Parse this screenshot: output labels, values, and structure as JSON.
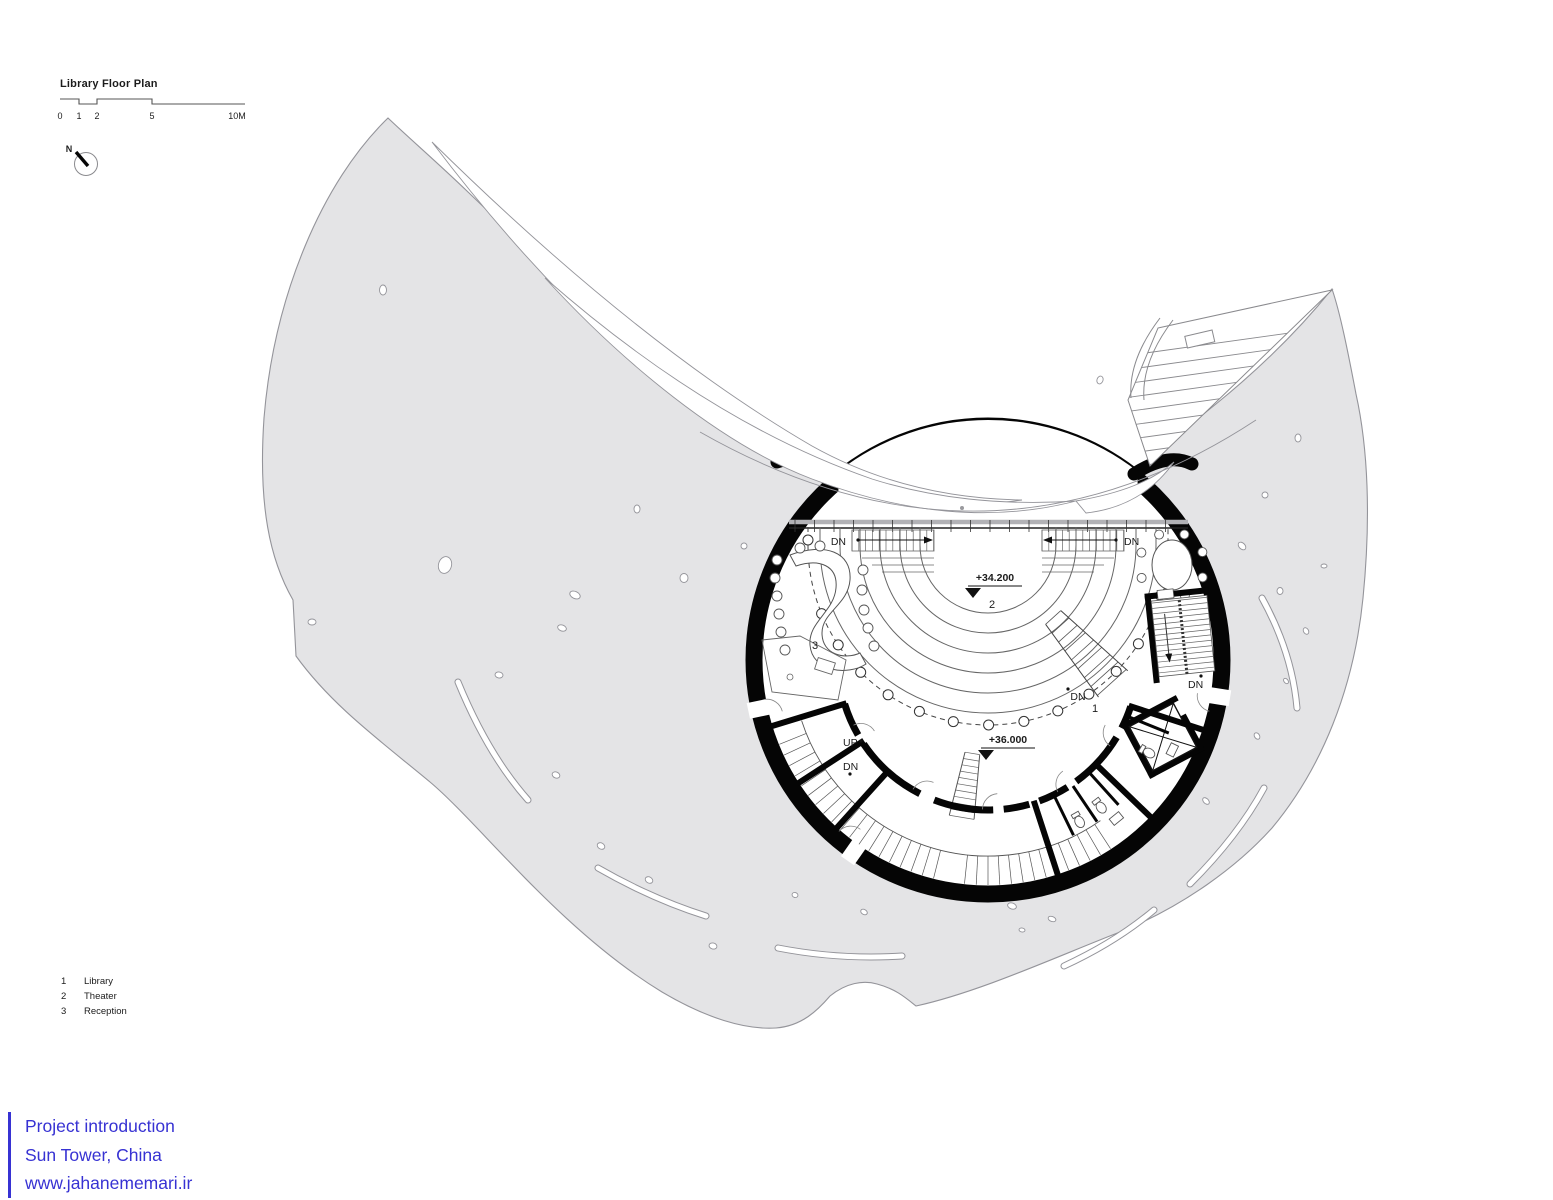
{
  "drawing": {
    "title": "Library Floor Plan",
    "scale_labels": [
      "0",
      "1",
      "2",
      "5",
      "10M"
    ],
    "north": "N",
    "levels": {
      "theater": "+34.200",
      "library": "+36.000"
    },
    "rooms": {
      "library": "1",
      "theater": "2",
      "reception": "3"
    },
    "stairs": {
      "up": "UP",
      "down": "DN"
    }
  },
  "legend": {
    "items": [
      {
        "number": "1",
        "label": "Library"
      },
      {
        "number": "2",
        "label": "Theater"
      },
      {
        "number": "3",
        "label": "Reception"
      }
    ]
  },
  "footer": {
    "lines": [
      "Project introduction",
      "Sun Tower, China",
      "www.jahanememari.ir"
    ],
    "accent_color": "#3732d3"
  },
  "palette": {
    "mass": "#e4e4e6",
    "outline": "#94949a",
    "wall": "#050505",
    "detail": "#555555"
  }
}
